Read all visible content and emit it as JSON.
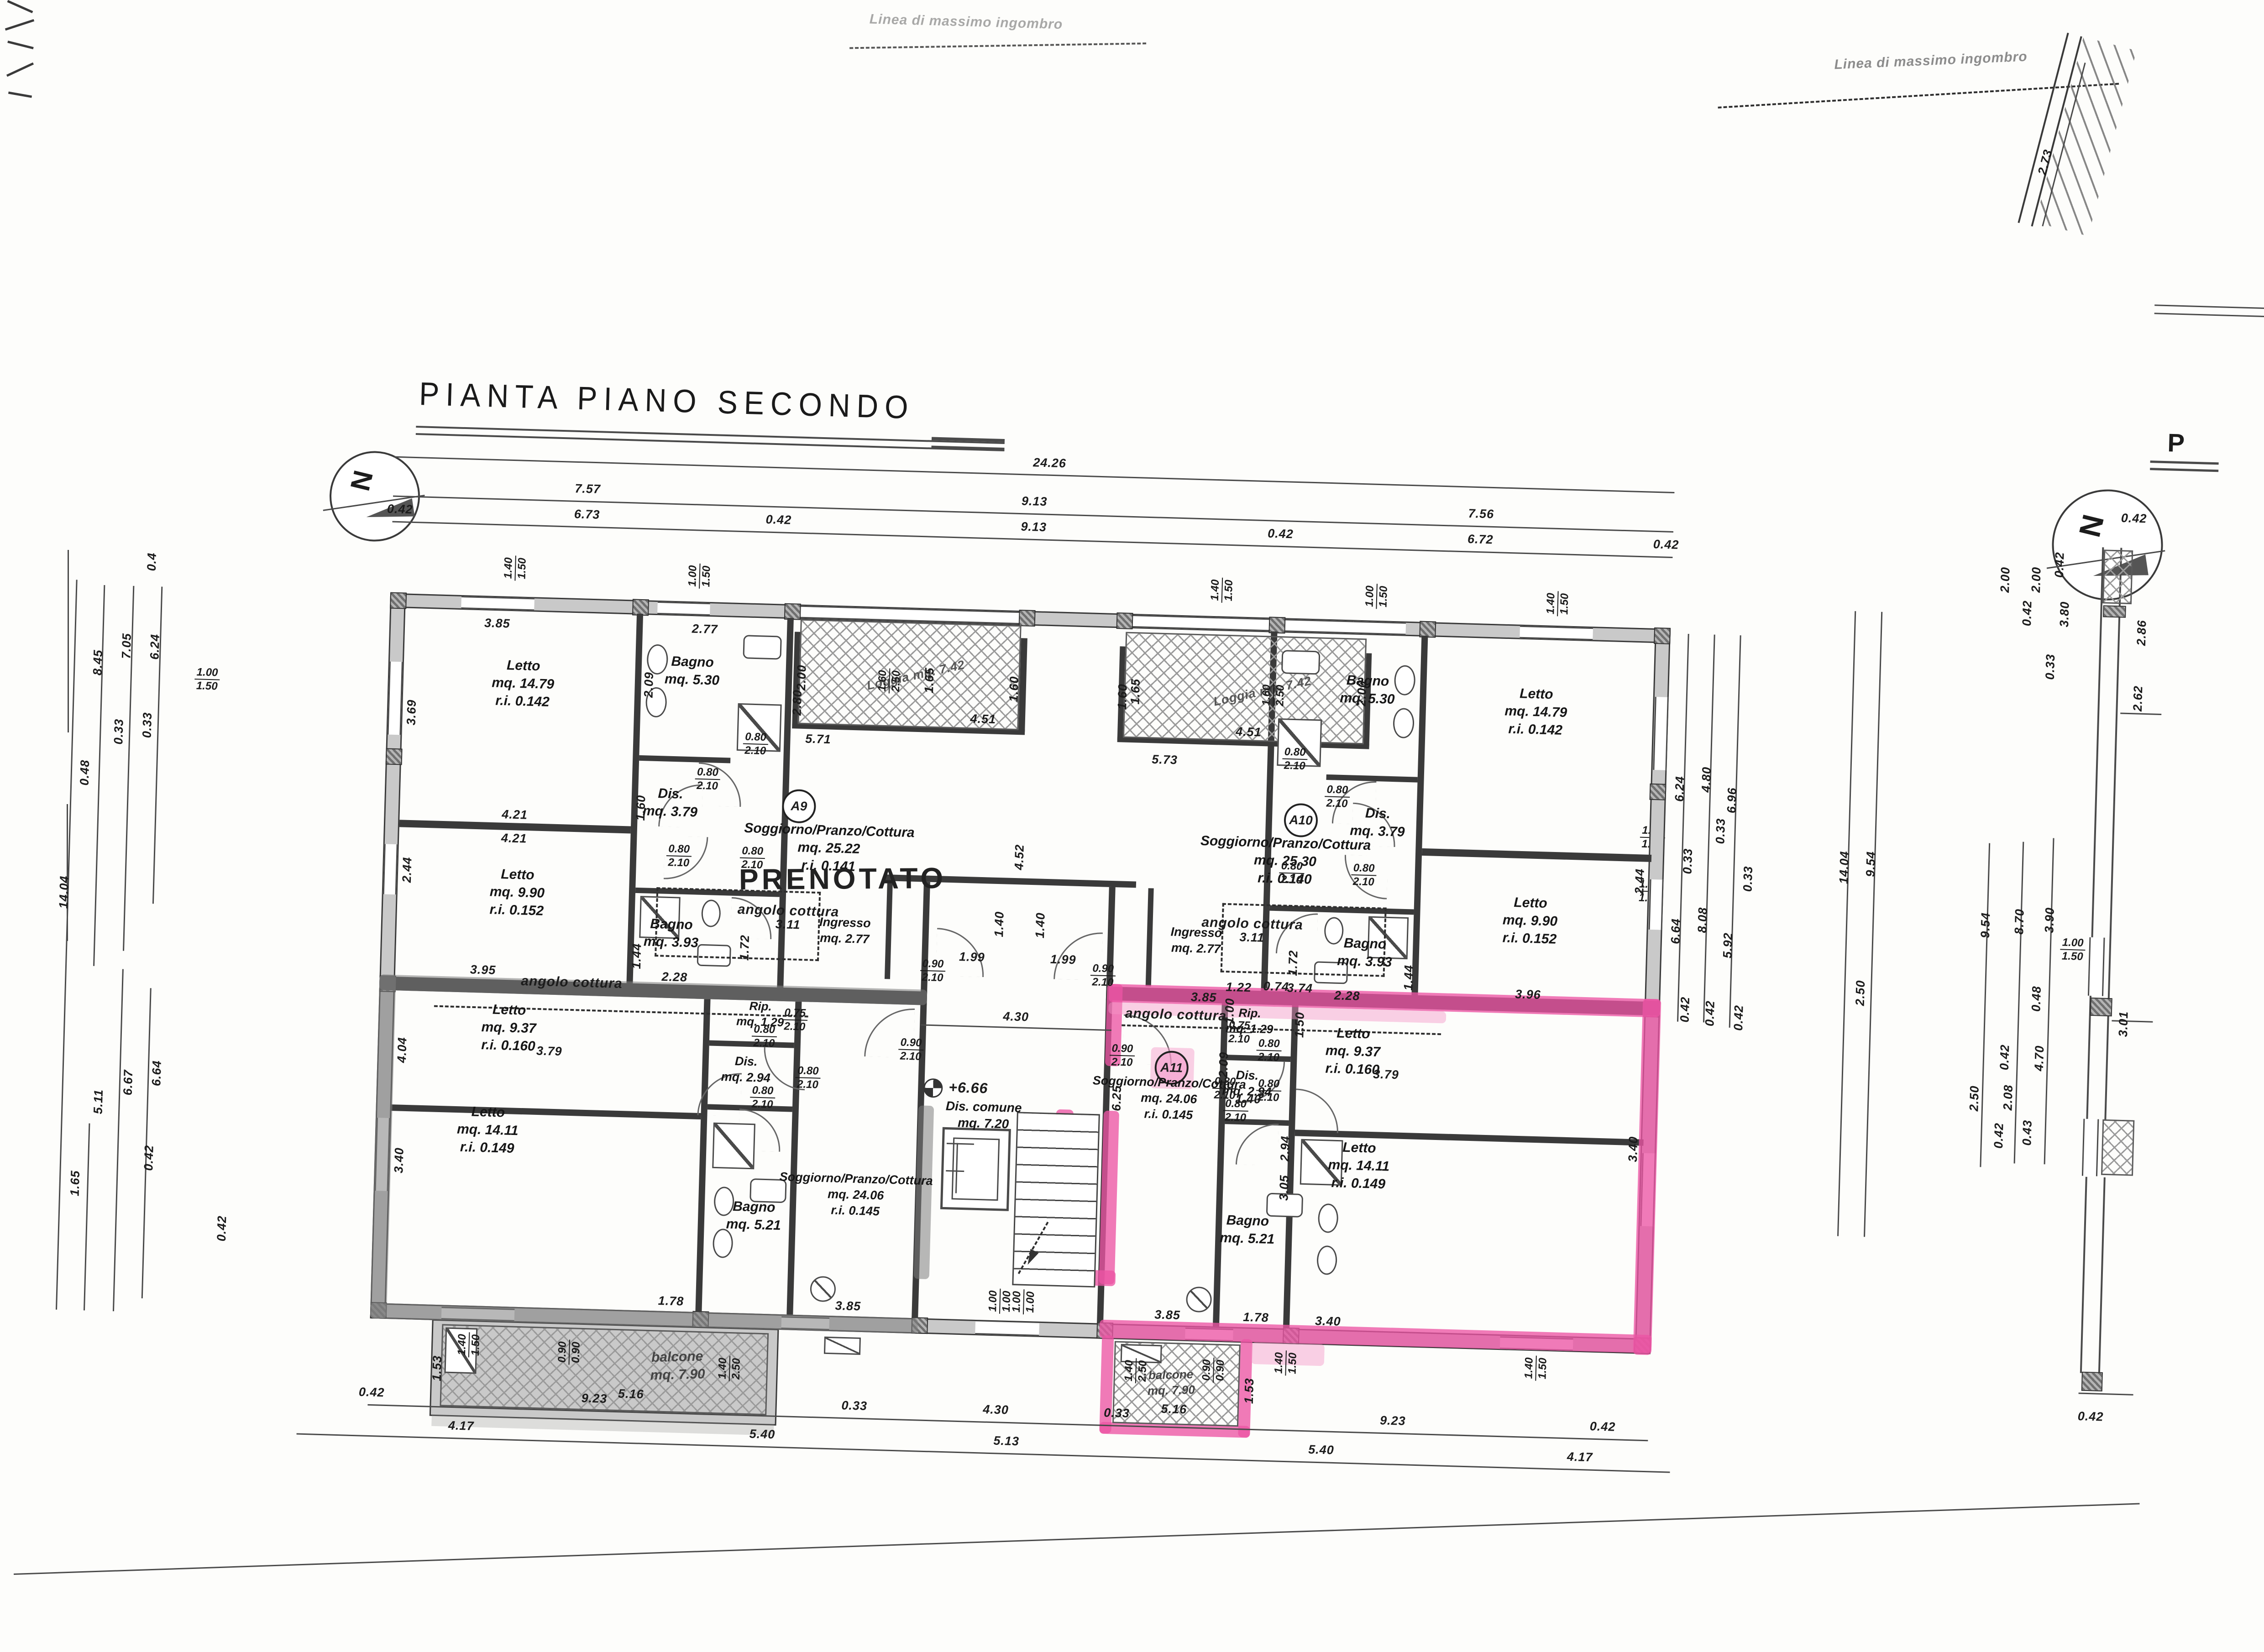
{
  "title": "PIANTA PIANO SECONDO",
  "notes": {
    "linea_top": "Linea di massimo ingombro",
    "linea_right": "Linea di massimo ingombro",
    "prenotato": "PRENOTATO",
    "north": "N",
    "p_mark": "P",
    "level": "+6.66"
  },
  "badges": {
    "a9": "A9",
    "a10": "A10",
    "a11": "A11"
  },
  "rooms": {
    "a9": {
      "letto1": [
        "Letto",
        "mq.  14.79",
        "r.i.  0.142"
      ],
      "letto2": [
        "Letto",
        "mq.  9.90",
        "r.i.  0.152"
      ],
      "bagno1": [
        "Bagno",
        "mq.  5.30"
      ],
      "bagno2": [
        "Bagno",
        "mq.  3.93"
      ],
      "dis": [
        "Dis.",
        "mq.  3.79"
      ],
      "sog": [
        "Soggiorno/Pranzo/Cottura",
        "mq.  25.22",
        "r.i.  0.141"
      ],
      "angolo": "angolo cottura",
      "ingresso": [
        "Ingresso",
        "mq.  2.77"
      ],
      "loggia": "Loggia  mq. 7.42"
    },
    "a10": {
      "letto1": [
        "Letto",
        "mq.  14.79",
        "r.i.  0.142"
      ],
      "letto2": [
        "Letto",
        "mq.  9.90",
        "r.i.  0.152"
      ],
      "bagno1": [
        "Bagno",
        "mq.  5.30"
      ],
      "bagno2": [
        "Bagno",
        "mq.  3.93"
      ],
      "dis": [
        "Dis.",
        "mq.  3.79"
      ],
      "sog": [
        "Soggiorno/Pranzo/Cottura",
        "mq.  25.30",
        "r.i.  0.140"
      ],
      "angolo": "angolo cottura",
      "ingresso": [
        "Ingresso",
        "mq.  2.77"
      ],
      "loggia": "Loggia  mq. 7.42"
    },
    "a8": {
      "letto1": [
        "Letto",
        "mq.  9.37",
        "r.i.  0.160"
      ],
      "letto2": [
        "Letto",
        "mq.  14.11",
        "r.i.  0.149"
      ],
      "bagno": [
        "Bagno",
        "mq.  5.21"
      ],
      "dis": [
        "Dis.",
        "mq.  2.94"
      ],
      "rip": [
        "Rip.",
        "mq.  1.29"
      ],
      "sog": [
        "Soggiorno/Pranzo/Cottura",
        "mq.  24.06",
        "r.i.  0.145"
      ],
      "angolo": "angolo cottura",
      "balcone": [
        "balcone",
        "mq.  7.90"
      ]
    },
    "a11": {
      "letto1": [
        "Letto",
        "mq.  9.37",
        "r.i.  0.160"
      ],
      "letto2": [
        "Letto",
        "mq.  14.11",
        "r.i.  0.149"
      ],
      "bagno": [
        "Bagno",
        "mq.  5.21"
      ],
      "dis": [
        "Dis.",
        "mq.  2.94"
      ],
      "rip": [
        "Rip.",
        "mq.  1.29"
      ],
      "sog": [
        "Soggiorno/Pranzo/Cottura",
        "mq.  24.06",
        "r.i.  0.145"
      ],
      "angolo": "angolo cottura",
      "balcone": [
        "balcone",
        "mq.  7.90"
      ]
    },
    "common": {
      "dis": [
        "Dis.  comune",
        "mq.  7.20"
      ]
    }
  },
  "dims": {
    "top": [
      "24.26",
      "7.57",
      "9.13",
      "7.56",
      "0.42",
      "6.73",
      "0.42",
      "9.13",
      "0.42",
      "6.72",
      "0.42"
    ],
    "left": [
      "14.04",
      "8.45",
      "7.05",
      "6.24",
      "0.4",
      "0.33",
      "0.33",
      "0.48",
      "5.11",
      "6.67",
      "6.64",
      "0.42",
      "1.65",
      "0.42",
      "2.50"
    ],
    "right": [
      "6.24",
      "4.80",
      "6.96",
      "0.33",
      "0.33",
      "0.33",
      "6.64",
      "8.08",
      "5.92",
      "0.42",
      "0.42",
      "0.42",
      "14.04",
      "9.54",
      "2.50"
    ],
    "bottom": [
      "0.42",
      "9.23",
      "0.33",
      "4.30",
      "0.33",
      "9.23",
      "0.42",
      "4.17",
      "5.40",
      "5.13",
      "5.40",
      "4.17"
    ],
    "sect": [
      "2.73",
      "0.42",
      "2.00",
      "2.00",
      "0.42",
      "0.42",
      "3.80",
      "0.33",
      "2.86",
      "2.62",
      "9.54",
      "8.70",
      "3.90",
      "0.48",
      "3.01",
      "0.42",
      "4.70",
      "2.50",
      "2.08",
      "0.42",
      "0.43",
      "0.42"
    ],
    "inner": [
      "3.85",
      "2.77",
      "2.09",
      "2.80",
      "1.60",
      "4.21",
      "4.21",
      "3.69",
      "2.44",
      "3.95",
      "1.44",
      "2.28",
      "1.72",
      "5.71",
      "5.73",
      "4.52",
      "1.99",
      "1.99",
      "1.40",
      "1.40",
      "4.30",
      "3.11",
      "3.11",
      "3.85",
      "1.22",
      "3.74",
      "1.00",
      "1.50",
      "2.09",
      "6.25",
      "1.40",
      "2.94",
      "3.05",
      "3.85",
      "1.78",
      "3.40",
      "3.40",
      "3.40",
      "4.04",
      "1.78",
      "3.85",
      "5.16",
      "5.16",
      "2.00",
      "2.00",
      "1.65",
      "1.65",
      "4.51",
      "4.51",
      "1.60",
      "1.60",
      "3.96",
      "2.44",
      "3.79",
      "3.79",
      "0.74",
      "1.53",
      "1.53",
      "2.28",
      "1.72",
      "1.44"
    ],
    "fracs": [
      [
        "1.40",
        "1.50"
      ],
      [
        "1.00",
        "1.50"
      ],
      [
        "0.80",
        "2.10"
      ],
      [
        "0.90",
        "2.10"
      ],
      [
        "0.75",
        "2.10"
      ],
      [
        "1.00",
        "1.00"
      ],
      [
        "1.60",
        "2.50"
      ],
      [
        "0.90",
        "0.90"
      ],
      [
        "1.40",
        "2.50"
      ]
    ]
  }
}
